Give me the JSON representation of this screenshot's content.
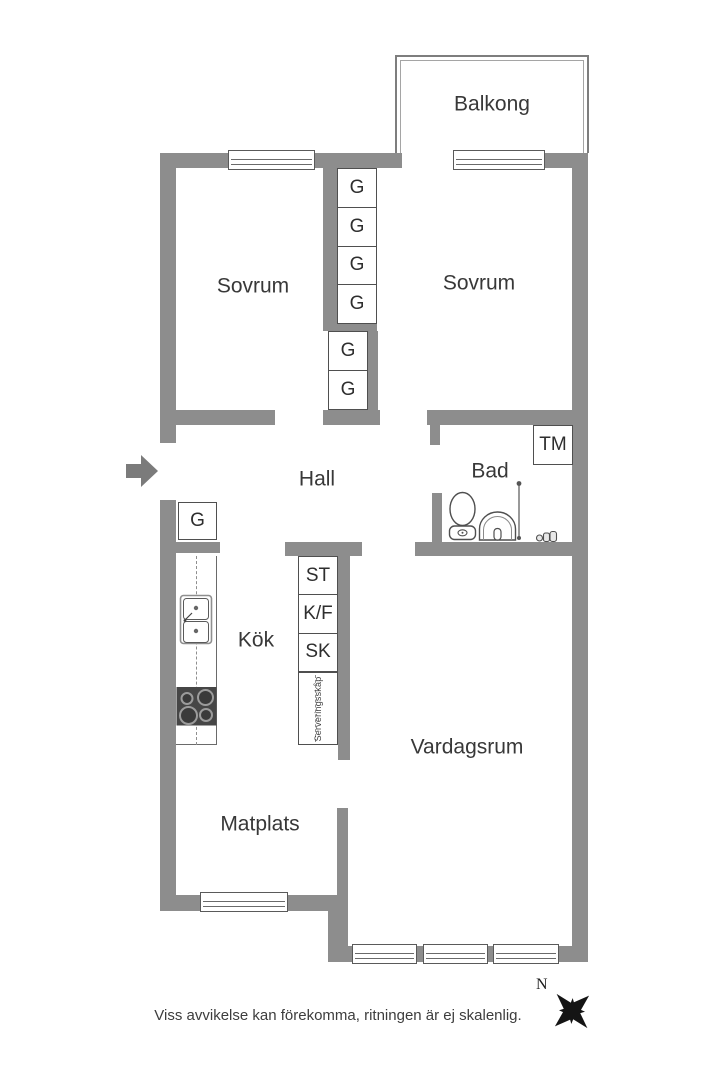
{
  "rooms": {
    "balcony": "Balkong",
    "bedroom_left": "Sovrum",
    "bedroom_right": "Sovrum",
    "hall": "Hall",
    "bathroom": "Bad",
    "kitchen": "Kök",
    "living_room": "Vardagsrum",
    "dining_area": "Matplats"
  },
  "wardrobes": {
    "between_bedrooms": [
      "G",
      "G",
      "G",
      "G"
    ],
    "hall": [
      "G",
      "G"
    ],
    "kitchen_entry": "G"
  },
  "fixtures": {
    "washing_machine": "TM"
  },
  "kitchen_units": {
    "pantry": [
      "ST",
      "K/F",
      "SK"
    ],
    "serving_cabinet": "Serveringsskåp"
  },
  "footer": {
    "compass_north": "N",
    "disclaimer": "Viss avvikelse kan förekomma, ritningen är ej skalenlig."
  },
  "colors": {
    "wall": "#8d8d8d",
    "line": "#4f4f4f",
    "text": "#383838",
    "appliance": "#464646"
  }
}
